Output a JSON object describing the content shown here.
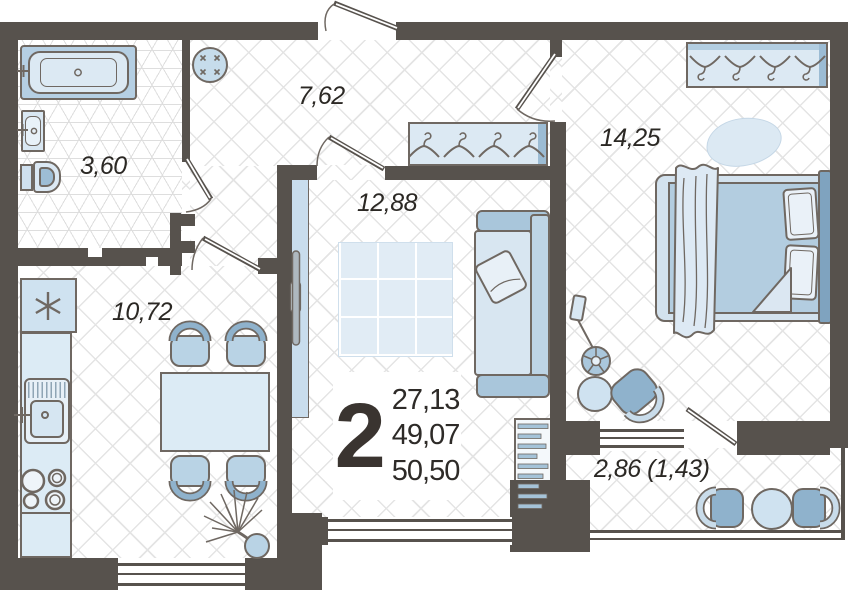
{
  "title": "2-room apartment floor plan",
  "summary": {
    "rooms_count": "2",
    "living_area": "27,13",
    "area_without_balcony": "49,07",
    "total_area": "50,50"
  },
  "rooms": [
    {
      "name": "bathroom",
      "area": "3,60"
    },
    {
      "name": "hallway",
      "area": "7,62"
    },
    {
      "name": "living-room",
      "area": "12,88"
    },
    {
      "name": "bedroom",
      "area": "14,25"
    },
    {
      "name": "kitchen",
      "area": "10,72"
    },
    {
      "name": "balcony",
      "area": "2,86 (1,43)"
    }
  ],
  "icons": {
    "fridge": "snowflake-icon",
    "wardrobe": "hanger-icon",
    "plant": "palm-icon",
    "lamp": "floor-lamp-icon"
  },
  "colors": {
    "wall": "#57524d",
    "outline": "#6f6862",
    "furniture_light": "#d9e7f2",
    "furniture_medium": "#b3cde0",
    "furniture_dark": "#8fb2cc",
    "floor_line": "#e4e4e4",
    "text": "#2b2824"
  }
}
